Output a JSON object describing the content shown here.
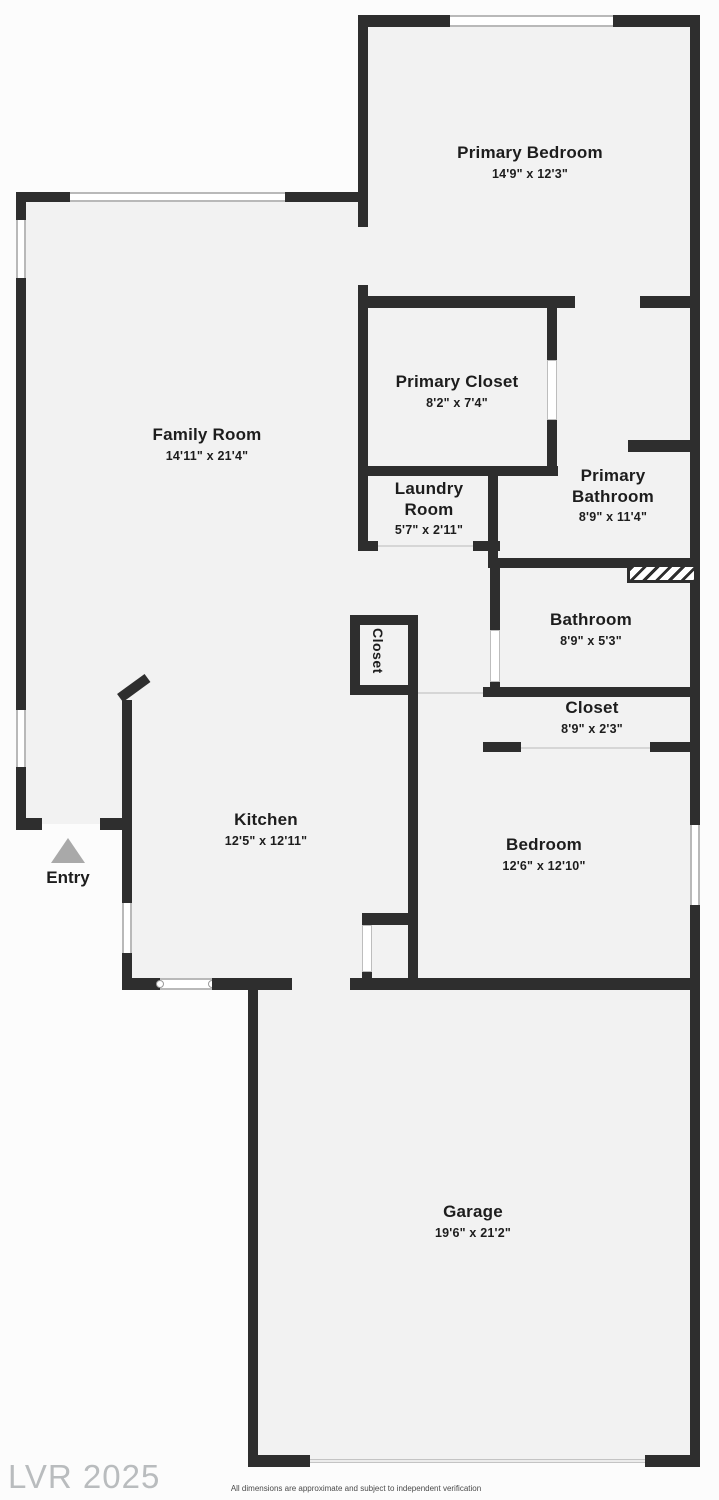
{
  "plan": {
    "rooms": {
      "primary_bedroom": {
        "name": "Primary Bedroom",
        "dims": "14'9\" x 12'3\""
      },
      "primary_closet": {
        "name": "Primary Closet",
        "dims": "8'2\" x 7'4\""
      },
      "family_room": {
        "name": "Family Room",
        "dims": "14'11\" x 21'4\""
      },
      "laundry_room": {
        "name": "Laundry Room",
        "dims": "5'7\" x 2'11\""
      },
      "primary_bathroom": {
        "name": "Primary Bathroom",
        "dims": "8'9\" x 11'4\""
      },
      "bathroom": {
        "name": "Bathroom",
        "dims": "8'9\" x 5'3\""
      },
      "hall_closet": {
        "name": "Closet"
      },
      "closet": {
        "name": "Closet",
        "dims": "8'9\" x 2'3\""
      },
      "kitchen": {
        "name": "Kitchen",
        "dims": "12'5\" x 12'11\""
      },
      "bedroom": {
        "name": "Bedroom",
        "dims": "12'6\" x 12'10\""
      },
      "garage": {
        "name": "Garage",
        "dims": "19'6\" x 21'2\""
      }
    },
    "entry_label": "Entry",
    "watermark": "LVR 2025",
    "disclaimer": "All dimensions are approximate and subject to independent verification",
    "colors": {
      "wall": "#2e2e2e",
      "floor": "#f2f2f2",
      "entry_triangle": "#a9a9a9",
      "watermark": "#b9bcbe"
    }
  }
}
